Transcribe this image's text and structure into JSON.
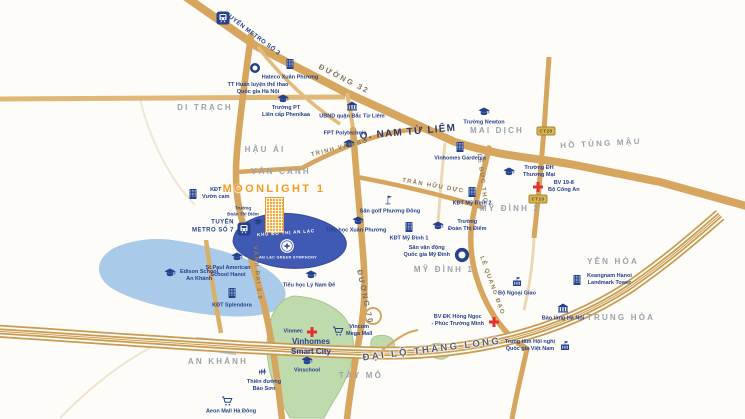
{
  "map": {
    "colors": {
      "road_gold": "#D6A55E",
      "road_gold_minor": "#E2BC7E",
      "road_faint": "#EFE3CE",
      "highway_gold": "#C99B4F",
      "navy": "#24418E",
      "label_navy": "#27408F",
      "red": "#E03131",
      "lake_blue": "#A9CAE8",
      "project_blue": "#4059B3",
      "green": "#BFDBAE",
      "orange": "#F4A93C",
      "area_gray": "#9AA2AC"
    },
    "project": {
      "name": "MOONLIGHT 1",
      "tower_color": "#F4A93C"
    },
    "text_labels": [
      {
        "id": "di-trach",
        "text": "DI TRẠCH",
        "x": 205,
        "y": 108,
        "rot": 0,
        "cls": "area"
      },
      {
        "id": "hau-ai",
        "text": "HẬU ÁI",
        "x": 265,
        "y": 150,
        "rot": 0,
        "cls": "area"
      },
      {
        "id": "van-canh",
        "text": "VÂN CANH",
        "x": 281,
        "y": 172,
        "rot": 0,
        "cls": "area"
      },
      {
        "id": "mai-dich",
        "text": "MAI DỊCH",
        "x": 497,
        "y": 131,
        "rot": 0,
        "cls": "area"
      },
      {
        "id": "ho-tung-mau",
        "text": "HỒ TÙNG MẬU",
        "x": 601,
        "y": 144,
        "rot": -3,
        "cls": "area"
      },
      {
        "id": "my-dinh-2",
        "text": "MỸ ĐÌNH 2",
        "x": 510,
        "y": 209,
        "rot": 0,
        "cls": "area"
      },
      {
        "id": "my-dinh-1",
        "text": "MỸ ĐÌNH 1",
        "x": 444,
        "y": 270,
        "rot": 0,
        "cls": "area"
      },
      {
        "id": "yen-hoa",
        "text": "YÊN HÒA",
        "x": 613,
        "y": 262,
        "rot": 0,
        "cls": "area"
      },
      {
        "id": "trung-hoa",
        "text": "TRUNG HÒA",
        "x": 621,
        "y": 318,
        "rot": 0,
        "cls": "area"
      },
      {
        "id": "an-khanh",
        "text": "AN KHÁNH",
        "x": 218,
        "y": 362,
        "rot": 0,
        "cls": "area"
      },
      {
        "id": "tay-mo",
        "text": "TÂY MỖ",
        "x": 361,
        "y": 376,
        "rot": 0,
        "cls": "area"
      },
      {
        "id": "q-nam-tu-liem",
        "text": "Q. NAM TỪ LIÊM",
        "x": 408,
        "y": 133,
        "rot": -5,
        "cls": "district"
      },
      {
        "id": "duong-32",
        "text": "ĐƯỜNG 32",
        "x": 344,
        "y": 79,
        "rot": 27,
        "cls": "road-big"
      },
      {
        "id": "metro-3",
        "text": "TUYẾN METRO SỐ 3",
        "x": 252,
        "y": 35,
        "rot": 37,
        "cls": "metro"
      },
      {
        "id": "metro-7",
        "text": "TUYẾN\nMETRO SỐ 7",
        "x": 234,
        "y": 227,
        "rot": 0,
        "cls": "metro",
        "align": "r"
      },
      {
        "id": "trinh-van-bo",
        "text": "TRỊNH VĂN BÔ",
        "x": 340,
        "y": 149,
        "rot": -14,
        "cls": "road"
      },
      {
        "id": "tran-huu-duc",
        "text": "TRẦN HỮU DỰC",
        "x": 433,
        "y": 187,
        "rot": 10,
        "cls": "road"
      },
      {
        "id": "le-duc-tho",
        "text": "LÊ ĐỨC THỌ",
        "x": 481,
        "y": 179,
        "rot": 83,
        "cls": "road"
      },
      {
        "id": "le-quang-dao",
        "text": "LÊ QUANG ĐẠO",
        "x": 491,
        "y": 286,
        "rot": 70,
        "cls": "road"
      },
      {
        "id": "duong-70",
        "text": "ĐƯỜNG 70",
        "x": 365,
        "y": 297,
        "rot": 78,
        "cls": "road-big"
      },
      {
        "id": "vanh-dai-3-5",
        "text": "VÀNH ĐAI 3.5",
        "x": 256,
        "y": 273,
        "rot": 85,
        "cls": "road"
      },
      {
        "id": "dai-lo-thang-long",
        "text": "ĐẠI LỘ THĂNG LONG",
        "x": 432,
        "y": 350,
        "rot": -7,
        "cls": "highway"
      },
      {
        "id": "moonlight-title",
        "text": "MOONLIGHT 1",
        "x": 274,
        "y": 190,
        "rot": 0,
        "cls": "project-title"
      },
      {
        "id": "kdt-an-lac",
        "text": "KHU ĐÔ THỊ AN LẠC",
        "x": 286,
        "y": 233,
        "rot": -4,
        "cls": "poly-text"
      },
      {
        "id": "an-lac-sub",
        "text": "AN LẠC GREEN SYMPHONY",
        "x": 288,
        "y": 258,
        "rot": 0,
        "cls": "poly-sub"
      },
      {
        "id": "truong-dtd-vancanh",
        "text": "Trường\nĐoàn Thị Điểm",
        "x": 243,
        "y": 211,
        "rot": 0,
        "cls": "tiny-poi"
      },
      {
        "id": "vinhomes-smart-city",
        "text": "Vinhomes\nSmart City",
        "x": 311,
        "y": 347,
        "rot": 0,
        "cls": "vin-title"
      }
    ],
    "pois": [
      {
        "id": "metro-3-station",
        "icon": "metro-icon",
        "ix": 223,
        "iy": 18,
        "size": 13
      },
      {
        "id": "metro-7-station",
        "icon": "metro-icon",
        "ix": 244,
        "iy": 229,
        "size": 13
      },
      {
        "id": "hateco-xuan-phuong",
        "icon": "building-icon",
        "ix": 290,
        "iy": 64,
        "label": "Hateco Xuân Phương",
        "lx": 290,
        "ly": 78
      },
      {
        "id": "tt-huan-luyen",
        "icon": "stadium-icon",
        "ix": 255,
        "iy": 68,
        "size": 12,
        "label": "TT Huấn luyện thể thao\nQuốc gia Hà Nội",
        "lx": 258,
        "ly": 89
      },
      {
        "id": "phenikaa",
        "icon": "school-icon",
        "ix": 283,
        "iy": 99,
        "label": "Trường PT\nLiên cấp Phenikaa",
        "lx": 286,
        "ly": 112
      },
      {
        "id": "ubnd-bac-tu-liem",
        "icon": "bank-icon",
        "ix": 352,
        "iy": 106,
        "label": "UBND quận Bắc Từ Liêm",
        "lx": 352,
        "ly": 117
      },
      {
        "id": "fpt-polytechnic",
        "icon": "school-icon",
        "ix": 349,
        "iy": 144,
        "label": "FPT Polytechnic",
        "lx": 345,
        "ly": 134
      },
      {
        "id": "truong-newton",
        "icon": "school-icon",
        "ix": 484,
        "iy": 112,
        "label": "Trường Newton",
        "lx": 484,
        "ly": 123
      },
      {
        "id": "vinhomes-gardenia",
        "icon": "building-icon",
        "ix": 460,
        "iy": 147,
        "label": "Vinhomes Gardenia",
        "lx": 460,
        "ly": 159
      },
      {
        "id": "dh-thuong-mai",
        "icon": "school-icon",
        "ix": 509,
        "iy": 172,
        "label": "Trường ĐH\nThương Mại",
        "lx": 523,
        "ly": 172,
        "align": "l"
      },
      {
        "id": "bv-19-8",
        "icon": "hospital-icon",
        "ix": 538,
        "iy": 187,
        "label": "BV 19-8\nBộ Công An",
        "lx": 548,
        "ly": 187,
        "align": "l"
      },
      {
        "id": "kdt-my-dinh-2",
        "icon": "building-icon",
        "ix": 472,
        "iy": 192,
        "label": "KĐT Mỹ Đình 2",
        "lx": 472,
        "ly": 204
      },
      {
        "id": "doan-thi-diem",
        "icon": "school-icon",
        "ix": 438,
        "iy": 226,
        "label": "Trường\nĐoàn Thị Điểm",
        "lx": 448,
        "ly": 226,
        "align": "l"
      },
      {
        "id": "kdt-my-dinh-1",
        "icon": "building-icon",
        "ix": 409,
        "iy": 227,
        "label": "KĐT Mỹ Đình 1",
        "lx": 409,
        "ly": 239
      },
      {
        "id": "san-golf",
        "icon": "golf-icon",
        "ix": 388,
        "iy": 200,
        "label": "Sân golf Phương Đông",
        "lx": 390,
        "ly": 212
      },
      {
        "id": "th-xuan-phuong",
        "icon": "school-icon",
        "ix": 358,
        "iy": 221,
        "label": "Tiểu học Xuân Phương",
        "lx": 356,
        "ly": 231
      },
      {
        "id": "svd-my-dinh",
        "icon": "stadium-icon",
        "ix": 462,
        "iy": 255,
        "size": 17,
        "label": "Sân vận động\nQuốc gia Mỹ Đình",
        "lx": 450,
        "ly": 252,
        "align": "r"
      },
      {
        "id": "bo-ngoai-giao",
        "icon": "gov-icon",
        "ix": 517,
        "iy": 282,
        "label": "Bộ Ngoại Giao",
        "lx": 517,
        "ly": 294
      },
      {
        "id": "keangnam",
        "icon": "building-icon",
        "ix": 577,
        "iy": 280,
        "label": "Keangnam Hanoi\nLandmark Tower",
        "lx": 587,
        "ly": 280,
        "align": "l"
      },
      {
        "id": "bao-tang-ha-noi",
        "icon": "bank-icon",
        "ix": 563,
        "iy": 308,
        "label": "Bảo tàng Hà Nội",
        "lx": 563,
        "ly": 319
      },
      {
        "id": "bv-hong-ngoc",
        "icon": "hospital-icon",
        "ix": 494,
        "iy": 322,
        "label": "BV ĐK Hồng Ngọc\n- Phúc Trường Minh",
        "lx": 484,
        "ly": 321,
        "align": "r"
      },
      {
        "id": "tt-hoi-nghi",
        "icon": "gov-icon",
        "ix": 565,
        "iy": 346,
        "label": "Trung tâm Hội nghị\nQuốc gia Việt Nam",
        "lx": 555,
        "ly": 346,
        "align": "r"
      },
      {
        "id": "kdt-vuon-cam",
        "icon": "building-icon",
        "ix": 193,
        "iy": 194,
        "label": "KĐT\nVườn cam",
        "lx": 202,
        "ly": 194,
        "align": "l"
      },
      {
        "id": "st-paul",
        "icon": "school-icon",
        "ix": 237,
        "iy": 257,
        "label": "St.Paul American\nSchool Hanoi",
        "lx": 228,
        "ly": 272
      },
      {
        "id": "edison-school",
        "icon": "school-icon",
        "ix": 170,
        "iy": 273,
        "label": "Edison School\nAn Khánh",
        "lx": 180,
        "ly": 276,
        "align": "l"
      },
      {
        "id": "kdt-splendora",
        "icon": "building-icon",
        "ix": 232,
        "iy": 293,
        "label": "KĐT Splendora",
        "lx": 232,
        "ly": 306
      },
      {
        "id": "th-ly-nam-de",
        "icon": "school-icon",
        "ix": 311,
        "iy": 275,
        "label": "Tiểu học Lý Nam Đế",
        "lx": 309,
        "ly": 286
      },
      {
        "id": "vinmec",
        "icon": "hospital-icon",
        "ix": 312,
        "iy": 332,
        "label": "Vinmec",
        "lx": 303,
        "ly": 332,
        "align": "r"
      },
      {
        "id": "vincom-mega-mall",
        "icon": "cart-icon",
        "ix": 338,
        "iy": 331,
        "label": "Vincom\nMega Mall",
        "lx": 346,
        "ly": 331,
        "align": "l"
      },
      {
        "id": "vinschool",
        "icon": "school-icon",
        "ix": 307,
        "iy": 361,
        "label": "Vinschool",
        "lx": 307,
        "ly": 371
      },
      {
        "id": "thien-duong-bao-son",
        "icon": "park-icon",
        "ix": 263,
        "iy": 371,
        "label": "Thiên đường\nBảo Sơn",
        "lx": 264,
        "ly": 386
      },
      {
        "id": "aeon-mall",
        "icon": "cart-icon",
        "ix": 227,
        "iy": 401,
        "label": "Aeon Mall Hà Đông",
        "lx": 231,
        "ly": 412
      },
      {
        "id": "an-lac-logo",
        "icon": "logo-circle",
        "ix": 287,
        "iy": 246,
        "size": 15
      },
      {
        "id": "dtd-vancanh-cap",
        "icon": "school-icon",
        "ix": 258,
        "iy": 222,
        "size": 9
      }
    ],
    "badges": [
      {
        "id": "badge-ct20-top",
        "text": "CT20",
        "x": 546,
        "y": 131
      },
      {
        "id": "badge-ct20-bottom",
        "text": "CT20",
        "x": 538,
        "y": 199
      }
    ]
  }
}
